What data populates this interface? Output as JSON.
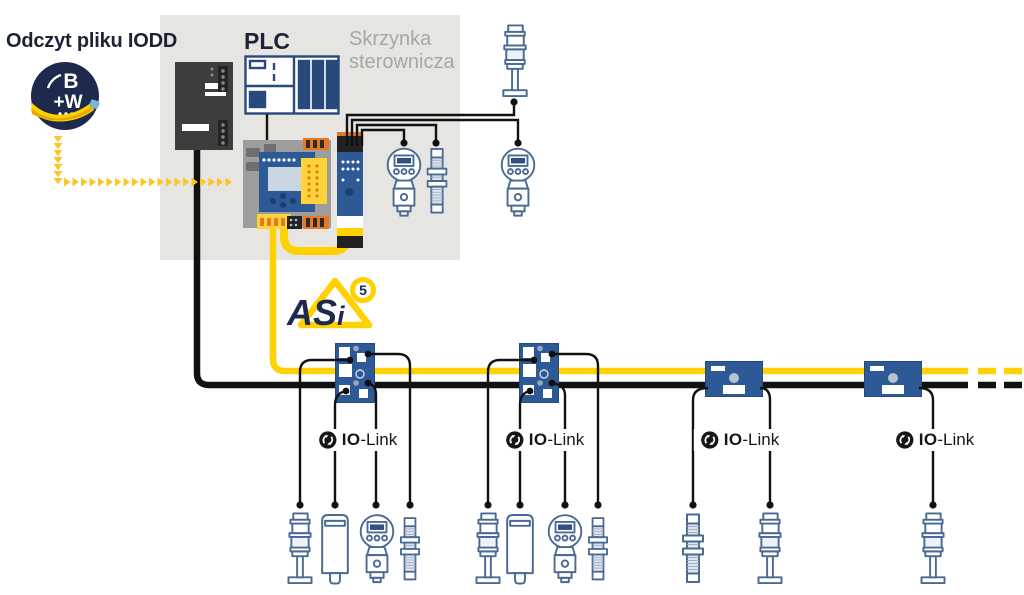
{
  "labels": {
    "iodd": "Odczyt pliku IODD",
    "plc": "PLC",
    "cabinet_line1": "Skrzynka",
    "cabinet_line2": "sterownicza"
  },
  "logos": {
    "bw": {
      "letter_b": "B",
      "letter_w": "+W"
    },
    "asi5": {
      "text_as": "AS",
      "text_i": "i",
      "badge": "5"
    }
  },
  "iolink": {
    "bold": "IO",
    "rest": "-Link",
    "count": 4
  },
  "iodd_flow": {
    "down_arrows": 7,
    "right_arrows": 20,
    "color": "#FFC425"
  },
  "colors": {
    "bus_yellow": "#FFD100",
    "bus_black": "#111111",
    "module_blue": "#2D5A96",
    "cabinet_gray": "#E7E5E2",
    "accent_orange": "#E87722",
    "logo_navy": "#1E2A4D",
    "sensor_outline": "#4A6A94",
    "text_gray": "#A9A7A3",
    "text_dark": "#1D2336"
  },
  "icons": {
    "bw_logo": "bw-software-logo",
    "power_supply": "power-supply-icon",
    "plc": "plc-icon",
    "gateway": "asi5-gateway-icon",
    "iolink_master": "asi5-iolink-master-module-icon",
    "signal_tower": "signal-tower-icon",
    "pressure_sensor": "pressure-sensor-icon",
    "proximity_sensor": "proximity-sensor-icon",
    "block_sensor": "level-sensor-icon",
    "asi_module_tall": "asi5-iolink-module-icon",
    "asi_module_flat": "asi5-module-icon",
    "iolink_badge": "iolink-logo-icon"
  },
  "network": {
    "cabinet_devices": [
      "power-supply",
      "plc",
      "asi5-gateway",
      "iolink-master-module",
      "pressure-sensor",
      "proximity-sensor"
    ],
    "external_devices": [
      "signal-tower",
      "pressure-sensor"
    ],
    "field_groups": [
      {
        "module": "asi5-iolink-module-tall",
        "devices": [
          "signal-tower",
          "level-sensor",
          "pressure-sensor",
          "proximity-sensor"
        ]
      },
      {
        "module": "asi5-iolink-module-tall",
        "devices": [
          "signal-tower",
          "level-sensor",
          "pressure-sensor",
          "proximity-sensor"
        ]
      },
      {
        "module": "asi5-module-flat",
        "devices": [
          "proximity-sensor",
          "signal-tower"
        ]
      },
      {
        "module": "asi5-module-flat",
        "devices": [
          "signal-tower"
        ]
      }
    ]
  }
}
